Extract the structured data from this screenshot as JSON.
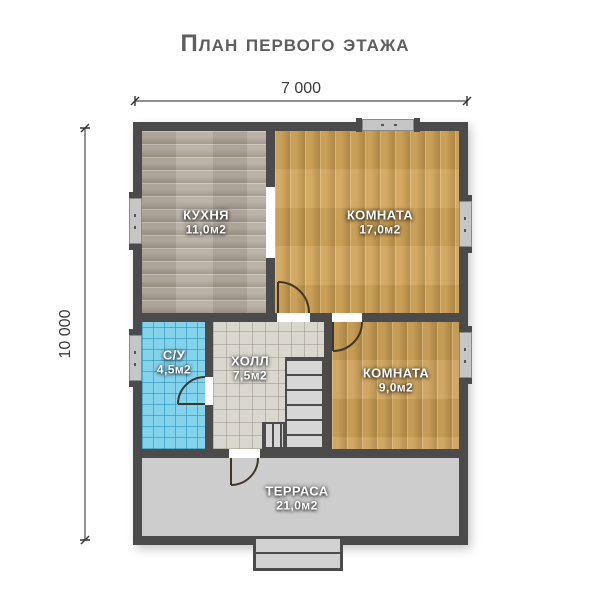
{
  "title": "План первого этажа",
  "dimensions": {
    "width": "7 000",
    "height": "10 000"
  },
  "rooms": {
    "kitchen": {
      "name": "КУХНЯ",
      "area": "11,0м2"
    },
    "room_large": {
      "name": "КОМНАТА",
      "area": "17,0м2"
    },
    "bathroom": {
      "name": "С/У",
      "area": "4,5м2"
    },
    "hall": {
      "name": "ХОЛЛ",
      "area": "7,5м2"
    },
    "room_small": {
      "name": "КОМНАТА",
      "area": "9,0м2"
    },
    "terrace": {
      "name": "ТЕРРАСА",
      "area": "21,0м2"
    }
  },
  "colors": {
    "wall": "#4b4b4b",
    "kitchen_floor": "#b6ada1",
    "wood_floor": "#d1a65b",
    "wood_floor_2": "#cda25a",
    "bathroom_tile": "#84d3ec",
    "hall_tile": "#dad7cf",
    "terrace_floor": "#cdcdcd",
    "window": "#c6c6c6",
    "title_text": "#5e5e5e",
    "dimension_text": "#3a3a3a",
    "door_line": "#3e3629"
  }
}
